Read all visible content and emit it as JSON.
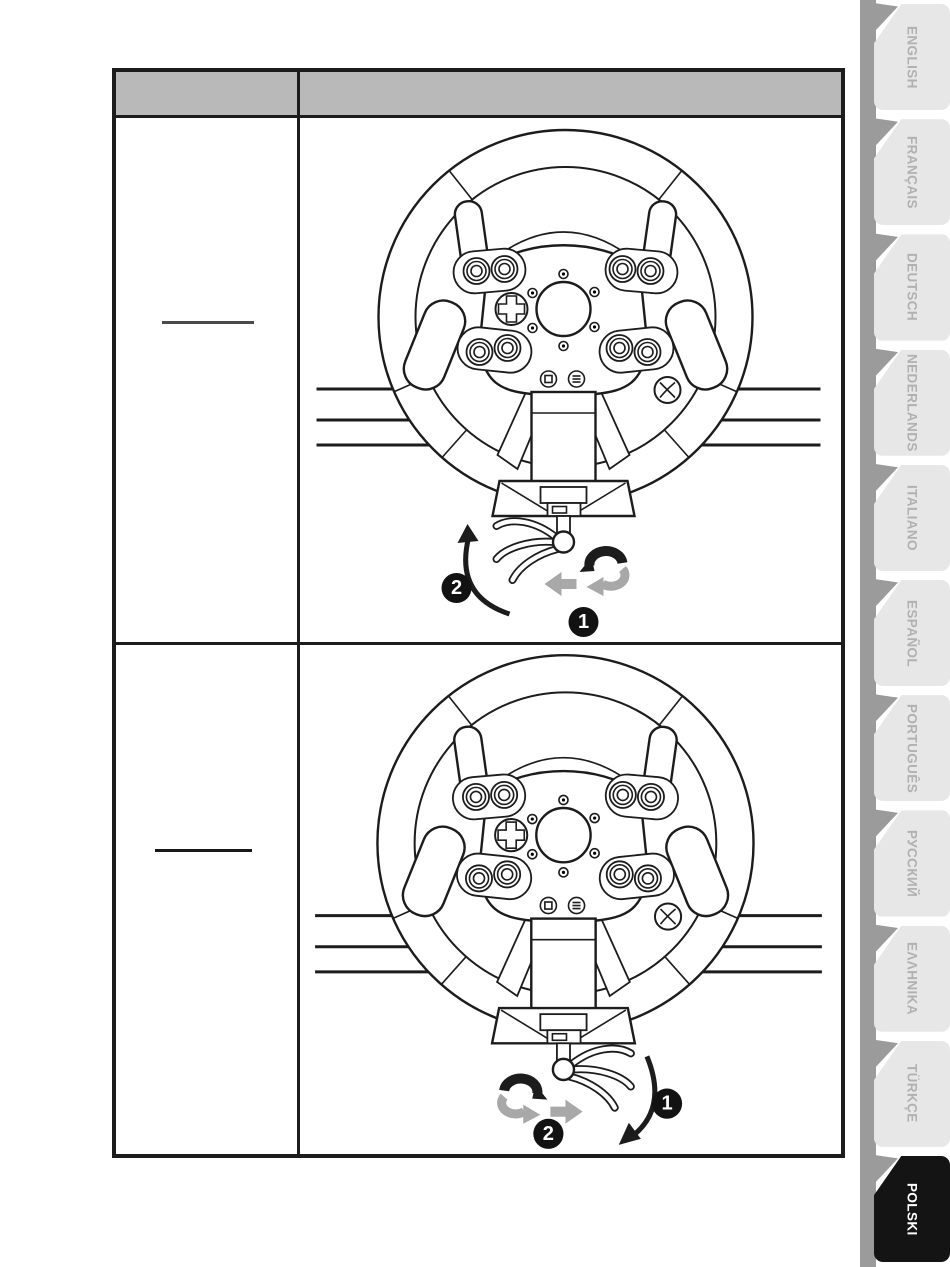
{
  "page": {
    "background": "#ffffff",
    "kind": "printed-manual-page"
  },
  "table": {
    "border_color": "#1c1c1c",
    "header": {
      "bg": "#b9b9b9",
      "left_label": "",
      "right_label": ""
    },
    "rows": [
      {
        "left_cell": {
          "underline_rule": true
        },
        "figure": {
          "name": "steering-wheel-table-clamp-step",
          "wings_direction": "left",
          "rotation_arrows_side": "right",
          "swing_arrow": "up-left",
          "badge_swing": "2",
          "badge_rotate": "1"
        }
      },
      {
        "left_cell": {
          "underline_rule": true
        },
        "figure": {
          "name": "steering-wheel-table-clamp-step",
          "wings_direction": "right",
          "rotation_arrows_side": "left",
          "swing_arrow": "down-right",
          "badge_swing": "1",
          "badge_rotate": "2"
        }
      }
    ]
  },
  "figure_colors": {
    "stroke": "#1c1c1c",
    "gray_arrow": "#a8a8a8",
    "badge_bg": "#121212",
    "badge_text": "#ffffff"
  },
  "sidebar": {
    "rail_color": "#9b9b9b",
    "tab_bg": "#e7e7e7",
    "tab_text_color": "#b1b1b1",
    "active_bg": "#141414",
    "active_text_color": "#ffffff",
    "tabs": [
      {
        "label": "ENGLISH",
        "active": false
      },
      {
        "label": "FRANÇAIS",
        "active": false
      },
      {
        "label": "DEUTSCH",
        "active": false
      },
      {
        "label": "NEDERLANDS",
        "active": false
      },
      {
        "label": "ITALIANO",
        "active": false
      },
      {
        "label": "ESPAÑOL",
        "active": false
      },
      {
        "label": "PORTUGUÊS",
        "active": false
      },
      {
        "label": "РУССКИЙ",
        "active": false
      },
      {
        "label": "ΕΛΛΗΝΙΚΑ",
        "active": false
      },
      {
        "label": "TÜRKÇE",
        "active": false
      },
      {
        "label": "POLSKI",
        "active": true
      }
    ]
  }
}
